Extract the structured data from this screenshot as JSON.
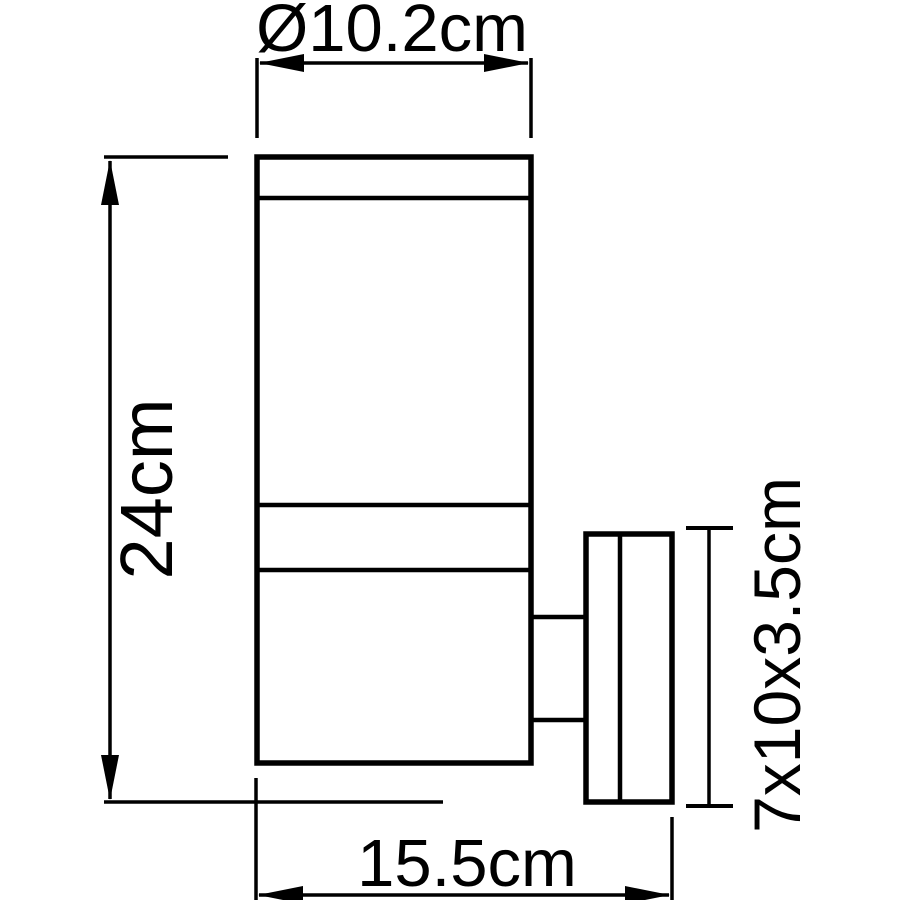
{
  "colors": {
    "ink": "#000000",
    "background": "#ffffff"
  },
  "drawing": {
    "type": "technical-dimension-drawing",
    "dimensions": {
      "diameter_label": "Ø10.2cm",
      "height_label": "24cm",
      "depth_label": "15.5cm",
      "bracket_label": "7x10x3.5cm"
    }
  }
}
